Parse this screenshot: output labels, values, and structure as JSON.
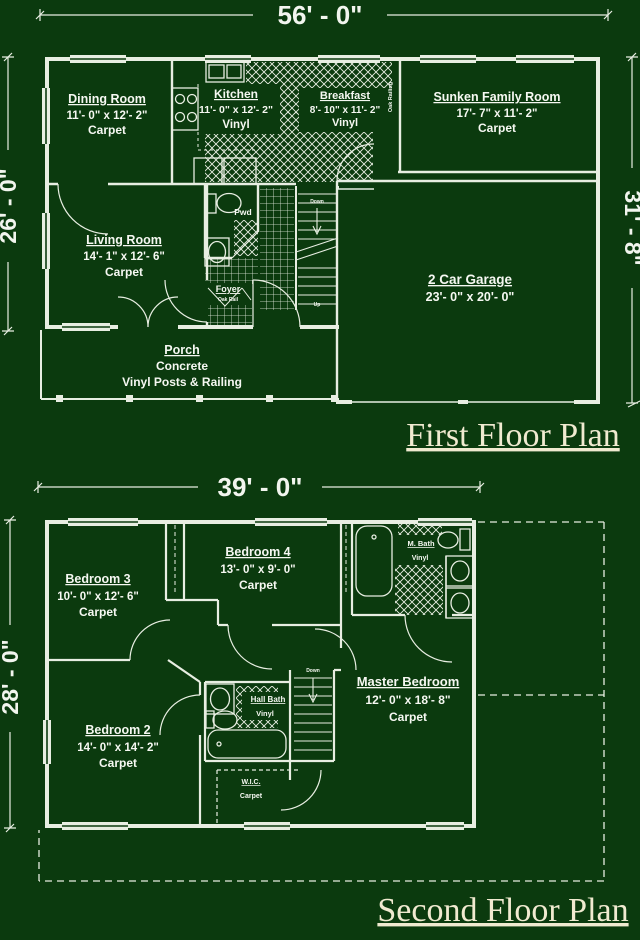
{
  "colors": {
    "background": "#0b3a0e",
    "line": "#e8eee2",
    "label_text": "#f6f8f2",
    "title_text": "#f0ead0"
  },
  "first_floor": {
    "title": "First Floor Plan",
    "dimensions": {
      "top": "56' - 0\"",
      "left": "26' - 0\"",
      "right": "31' - 8\""
    },
    "rooms": {
      "dining": {
        "name": "Dining Room",
        "size": "11'- 0\" x 12'- 2\"",
        "floor": "Carpet"
      },
      "kitchen": {
        "name": "Kitchen",
        "size": "11'- 0\" x 12'- 2\"",
        "floor": "Vinyl"
      },
      "breakfast": {
        "name": "Breakfast",
        "size": "8'- 10\" x 11'- 2\"",
        "floor": "Vinyl"
      },
      "family": {
        "name": "Sunken Family Room",
        "size": "17'- 7\" x 11'- 2\"",
        "floor": "Carpet"
      },
      "living": {
        "name": "Living Room",
        "size": "14'- 1\" x 12'- 6\"",
        "floor": "Carpet"
      },
      "powder": {
        "name": "Pwd"
      },
      "foyer": {
        "name": "Foyer",
        "note": "Oak Rail"
      },
      "garage": {
        "name": "2 Car Garage",
        "size": "23'- 0\" x 20'- 0\""
      },
      "porch": {
        "name": "Porch",
        "floor": "Concrete",
        "note": "Vinyl Posts & Railing"
      }
    },
    "annotations": {
      "stair_down": "Down",
      "stair_up": "Up",
      "railing": "Oak Railing"
    }
  },
  "second_floor": {
    "title": "Second Floor Plan",
    "dimensions": {
      "top": "39' - 0\"",
      "left": "28' - 0\""
    },
    "rooms": {
      "bedroom3": {
        "name": "Bedroom 3",
        "size": "10'- 0\" x 12'- 6\"",
        "floor": "Carpet"
      },
      "bedroom4": {
        "name": "Bedroom 4",
        "size": "13'- 0\" x 9'- 0\"",
        "floor": "Carpet"
      },
      "mbath": {
        "name": "M. Bath",
        "floor": "Vinyl"
      },
      "bedroom2": {
        "name": "Bedroom 2",
        "size": "14'- 0\" x 14'- 2\"",
        "floor": "Carpet"
      },
      "hallbath": {
        "name": "Hall Bath",
        "floor": "Vinyl"
      },
      "master": {
        "name": "Master Bedroom",
        "size": "12'- 0\" x 18'- 8\"",
        "floor": "Carpet"
      },
      "wic": {
        "name": "W.I.C.",
        "floor": "Carpet"
      }
    },
    "annotations": {
      "stair_down": "Down"
    }
  }
}
